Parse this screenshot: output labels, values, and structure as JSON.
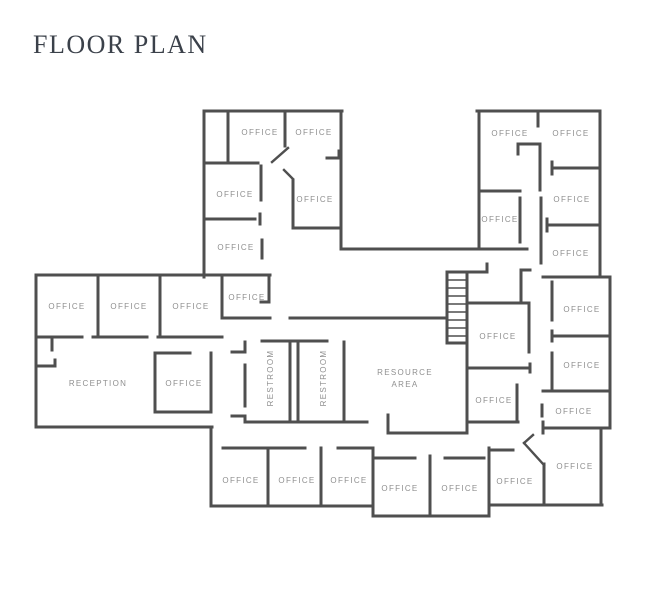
{
  "title": "FLOOR PLAN",
  "colors": {
    "background": "#ffffff",
    "wall": "#4f4f4f",
    "label": "#8f8f8f",
    "title": "#3b414a"
  },
  "plan": {
    "width": 646,
    "height": 588,
    "rooms": [
      {
        "id": "office-nw-1",
        "label": "OFFICE",
        "x": 260,
        "y": 135
      },
      {
        "id": "office-nw-2",
        "label": "OFFICE",
        "x": 314,
        "y": 135
      },
      {
        "id": "office-nw-3",
        "label": "OFFICE",
        "x": 235,
        "y": 197
      },
      {
        "id": "office-nw-4",
        "label": "OFFICE",
        "x": 315,
        "y": 202
      },
      {
        "id": "office-nw-5",
        "label": "OFFICE",
        "x": 236,
        "y": 250
      },
      {
        "id": "office-ne-1",
        "label": "OFFICE",
        "x": 510,
        "y": 136
      },
      {
        "id": "office-ne-2",
        "label": "OFFICE",
        "x": 571,
        "y": 136
      },
      {
        "id": "office-ne-3",
        "label": "OFFICE",
        "x": 572,
        "y": 202
      },
      {
        "id": "office-ne-4",
        "label": "OFFICE",
        "x": 500,
        "y": 222
      },
      {
        "id": "office-ne-5",
        "label": "OFFICE",
        "x": 571,
        "y": 256
      },
      {
        "id": "office-w-1",
        "label": "OFFICE",
        "x": 67,
        "y": 309
      },
      {
        "id": "office-w-2",
        "label": "OFFICE",
        "x": 129,
        "y": 309
      },
      {
        "id": "office-w-3",
        "label": "OFFICE",
        "x": 191,
        "y": 309
      },
      {
        "id": "office-center-left",
        "label": "OFFICE",
        "x": 247,
        "y": 300
      },
      {
        "id": "reception",
        "label": "RECEPTION",
        "x": 98,
        "y": 386
      },
      {
        "id": "office-reception",
        "label": "OFFICE",
        "x": 184,
        "y": 386
      },
      {
        "id": "restroom-1",
        "label": "RESTROOM",
        "x": 273,
        "y": 378,
        "rot": -90
      },
      {
        "id": "restroom-2",
        "label": "RESTROOM",
        "x": 326,
        "y": 378,
        "rot": -90
      },
      {
        "id": "resource-area-line1",
        "label": "RESOURCE",
        "x": 405,
        "y": 375
      },
      {
        "id": "resource-area-line2",
        "label": "AREA",
        "x": 405,
        "y": 387
      },
      {
        "id": "office-center-1",
        "label": "OFFICE",
        "x": 498,
        "y": 339
      },
      {
        "id": "office-center-2",
        "label": "OFFICE",
        "x": 494,
        "y": 403
      },
      {
        "id": "office-e-1",
        "label": "OFFICE",
        "x": 582,
        "y": 312
      },
      {
        "id": "office-e-2",
        "label": "OFFICE",
        "x": 582,
        "y": 368
      },
      {
        "id": "office-e-3",
        "label": "OFFICE",
        "x": 574,
        "y": 414
      },
      {
        "id": "office-e-4",
        "label": "OFFICE",
        "x": 575,
        "y": 469
      },
      {
        "id": "office-s-1",
        "label": "OFFICE",
        "x": 241,
        "y": 483
      },
      {
        "id": "office-s-2",
        "label": "OFFICE",
        "x": 297,
        "y": 483
      },
      {
        "id": "office-s-3",
        "label": "OFFICE",
        "x": 349,
        "y": 483
      },
      {
        "id": "office-s-4",
        "label": "OFFICE",
        "x": 400,
        "y": 491
      },
      {
        "id": "office-s-5",
        "label": "OFFICE",
        "x": 460,
        "y": 491
      },
      {
        "id": "office-s-6",
        "label": "OFFICE",
        "x": 515,
        "y": 484
      }
    ],
    "walls": [
      [
        204,
        111,
        342,
        111
      ],
      [
        204,
        111,
        204,
        277
      ],
      [
        341,
        111,
        341,
        249
      ],
      [
        228,
        111,
        228,
        163
      ],
      [
        204,
        163,
        258,
        163
      ],
      [
        261,
        166,
        261,
        200
      ],
      [
        285,
        111,
        285,
        146
      ],
      [
        293,
        180,
        293,
        228
      ],
      [
        293,
        228,
        341,
        228
      ],
      [
        204,
        219,
        255,
        219
      ],
      [
        260,
        214,
        260,
        224
      ],
      [
        262,
        240,
        262,
        258
      ],
      [
        327,
        158,
        339,
        158
      ],
      [
        339,
        151,
        339,
        158
      ],
      [
        36,
        275,
        270,
        275
      ],
      [
        36,
        275,
        36,
        427
      ],
      [
        52,
        338,
        52,
        350
      ],
      [
        36,
        366,
        55,
        366
      ],
      [
        55,
        360,
        55,
        366
      ],
      [
        98,
        275,
        98,
        337
      ],
      [
        160,
        275,
        160,
        337
      ],
      [
        222,
        275,
        222,
        318
      ],
      [
        36,
        337,
        82,
        337
      ],
      [
        93,
        337,
        147,
        337
      ],
      [
        158,
        337,
        222,
        337
      ],
      [
        269,
        275,
        269,
        302
      ],
      [
        261,
        302,
        269,
        302
      ],
      [
        223,
        318,
        270,
        318
      ],
      [
        290,
        318,
        447,
        318
      ],
      [
        155,
        353,
        190,
        353
      ],
      [
        155,
        353,
        155,
        412
      ],
      [
        155,
        412,
        211,
        412
      ],
      [
        211,
        353,
        211,
        412
      ],
      [
        36,
        427,
        212,
        427
      ],
      [
        211,
        427,
        211,
        506
      ],
      [
        211,
        506,
        373,
        506
      ],
      [
        223,
        448,
        305,
        448
      ],
      [
        268,
        448,
        268,
        506
      ],
      [
        321,
        448,
        321,
        506
      ],
      [
        338,
        448,
        371,
        448
      ],
      [
        373,
        448,
        373,
        516
      ],
      [
        373,
        516,
        489,
        516
      ],
      [
        375,
        458,
        415,
        458
      ],
      [
        430,
        456,
        430,
        516
      ],
      [
        445,
        458,
        484,
        458
      ],
      [
        489,
        448,
        489,
        516
      ],
      [
        489,
        450,
        513,
        450
      ],
      [
        489,
        505,
        602,
        505
      ],
      [
        544,
        464,
        544,
        505
      ],
      [
        543,
        422,
        543,
        433
      ],
      [
        543,
        428,
        610,
        428
      ],
      [
        601,
        428,
        601,
        505
      ],
      [
        543,
        391,
        610,
        391
      ],
      [
        610,
        277,
        610,
        428
      ],
      [
        542,
        405,
        542,
        416
      ],
      [
        552,
        336,
        610,
        336
      ],
      [
        552,
        331,
        552,
        341
      ],
      [
        552,
        353,
        552,
        390
      ],
      [
        543,
        277,
        610,
        277
      ],
      [
        552,
        282,
        552,
        320
      ],
      [
        521,
        270,
        521,
        302
      ],
      [
        521,
        270,
        530,
        270
      ],
      [
        468,
        303,
        529,
        303
      ],
      [
        529,
        303,
        529,
        352
      ],
      [
        470,
        368,
        530,
        368
      ],
      [
        530,
        364,
        530,
        372
      ],
      [
        517,
        385,
        517,
        422
      ],
      [
        468,
        422,
        518,
        422
      ],
      [
        467,
        343,
        467,
        433
      ],
      [
        388,
        433,
        467,
        433
      ],
      [
        388,
        415,
        388,
        433
      ],
      [
        262,
        341,
        327,
        341
      ],
      [
        245,
        342,
        245,
        352
      ],
      [
        245,
        365,
        245,
        406
      ],
      [
        245,
        417,
        245,
        422
      ],
      [
        232,
        352,
        245,
        352
      ],
      [
        232,
        416,
        245,
        416
      ],
      [
        290,
        341,
        290,
        422
      ],
      [
        298,
        341,
        298,
        422
      ],
      [
        344,
        342,
        344,
        422
      ],
      [
        245,
        422,
        367,
        422
      ],
      [
        341,
        249,
        527,
        249
      ],
      [
        479,
        111,
        479,
        249
      ],
      [
        477,
        111,
        600,
        111
      ],
      [
        600,
        111,
        600,
        277
      ],
      [
        538,
        111,
        538,
        126
      ],
      [
        518,
        144,
        540,
        144
      ],
      [
        518,
        144,
        518,
        154
      ],
      [
        540,
        144,
        540,
        190
      ],
      [
        541,
        198,
        541,
        263
      ],
      [
        552,
        168,
        600,
        168
      ],
      [
        552,
        162,
        552,
        174
      ],
      [
        547,
        225,
        600,
        225
      ],
      [
        547,
        219,
        547,
        231
      ],
      [
        479,
        191,
        520,
        191
      ],
      [
        520,
        198,
        520,
        242
      ]
    ],
    "doors": [
      [
        272,
        162,
        288,
        148
      ],
      [
        284,
        170,
        293,
        179
      ],
      [
        524,
        443,
        544,
        465
      ],
      [
        524,
        443,
        533,
        435
      ]
    ],
    "stairs": {
      "rails": [
        [
          447,
          272,
          447,
          343
        ],
        [
          467,
          272,
          467,
          343
        ]
      ],
      "cap": [
        447,
        272,
        487,
        272
      ],
      "cap_tick": [
        487,
        264,
        487,
        272
      ],
      "bottom": [
        447,
        343,
        467,
        343
      ],
      "rung_ys": [
        280,
        288,
        296,
        304,
        312,
        320,
        328,
        336
      ],
      "rung_x1": 447,
      "rung_x2": 467
    }
  }
}
